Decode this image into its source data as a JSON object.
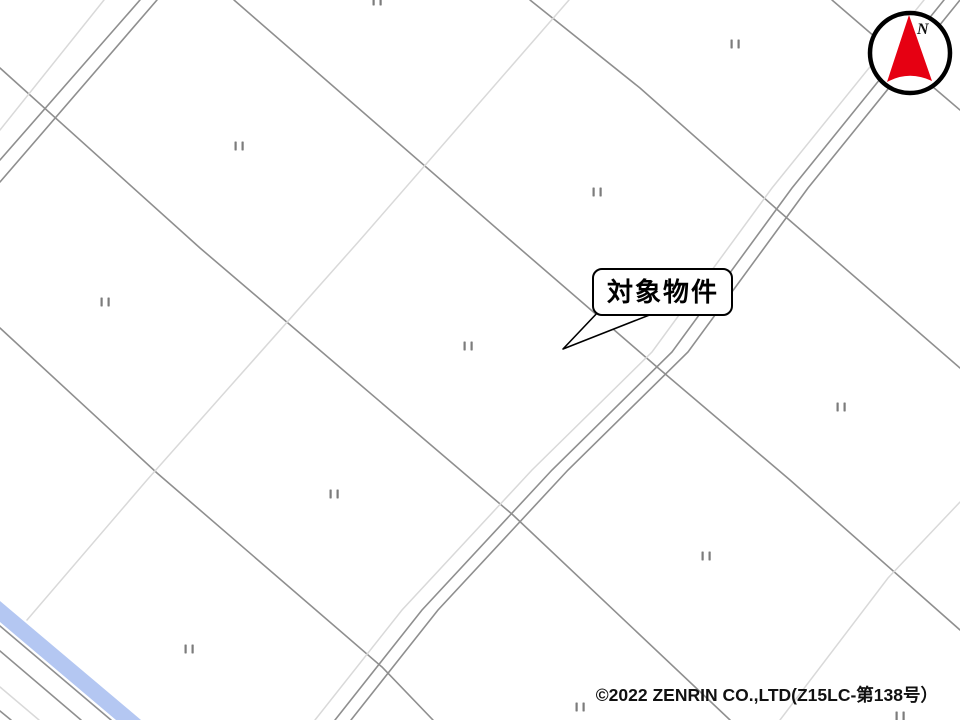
{
  "map": {
    "background": "#ffffff",
    "colors": {
      "parcel_dark": "#8f8f8f",
      "parcel_light": "#d9d9d9",
      "water_fill": "#b4c7f2",
      "compass_red": "#e60012",
      "ink": "#000000"
    },
    "water": {
      "name": "canal-band",
      "points": "0,601 141,720 116,720 0,622"
    },
    "lines": [
      {
        "id": "parcel-line-a",
        "color": "dark",
        "points": "0,68 200,248 513,515 730,720"
      },
      {
        "id": "parcel-line-e",
        "color": "dark",
        "points": "0,328 157,473 382,667 433,720"
      },
      {
        "id": "parcel-line-b",
        "color": "dark",
        "points": "234,0 510,240 657,367 790,480 960,630"
      },
      {
        "id": "parcel-line-c",
        "color": "dark",
        "points": "530,0 640,88 780,212 960,368"
      },
      {
        "id": "parcel-line-d",
        "color": "dark",
        "points": "832,0 933,87 960,110"
      },
      {
        "id": "parcel-line-l1",
        "color": "light",
        "points": "569,0 360,240 147,480 27,620"
      },
      {
        "id": "parcel-line-l3",
        "color": "light",
        "points": "960,502 888,578 780,720"
      },
      {
        "id": "road-main-left-edge",
        "color": "dark",
        "points": "944,0 792,188 672,352 552,470 422,610 335,720"
      },
      {
        "id": "road-main-right-edge",
        "color": "dark",
        "points": "960,0 808,188 688,352 568,470 438,610 351,720"
      },
      {
        "id": "road-main-side-light",
        "color": "light",
        "points": "924,0 772,188 652,352 532,470 402,610 315,720"
      },
      {
        "id": "road-left-edge-1",
        "color": "dark",
        "points": "140,0 0,160"
      },
      {
        "id": "road-left-edge-2",
        "color": "dark",
        "points": "157,0 0,182"
      },
      {
        "id": "road-left-side-light",
        "color": "light",
        "points": "104,0 0,130"
      },
      {
        "id": "canal-lower-edge",
        "color": "dark",
        "points": "0,626 111,720"
      },
      {
        "id": "canal-road-edge",
        "color": "dark",
        "points": "0,651 81,720"
      },
      {
        "id": "canal-side-light",
        "color": "light",
        "points": "0,687 39,720"
      },
      {
        "id": "canal-corner-line",
        "color": "dark",
        "points": "0,711 11,720"
      }
    ],
    "field_symbols": [
      [
        239,
        146
      ],
      [
        597,
        192
      ],
      [
        735,
        44
      ],
      [
        105,
        302
      ],
      [
        468,
        346
      ],
      [
        841,
        407
      ],
      [
        334,
        494
      ],
      [
        580,
        707
      ],
      [
        706,
        556
      ],
      [
        189,
        649
      ],
      [
        900,
        716
      ],
      [
        377,
        1
      ]
    ]
  },
  "callout": {
    "label": "対象物件"
  },
  "compass": {
    "label": "N"
  },
  "footer": {
    "copyright": "©2022 ZENRIN CO.,LTD(Z15LC-第138号）"
  }
}
